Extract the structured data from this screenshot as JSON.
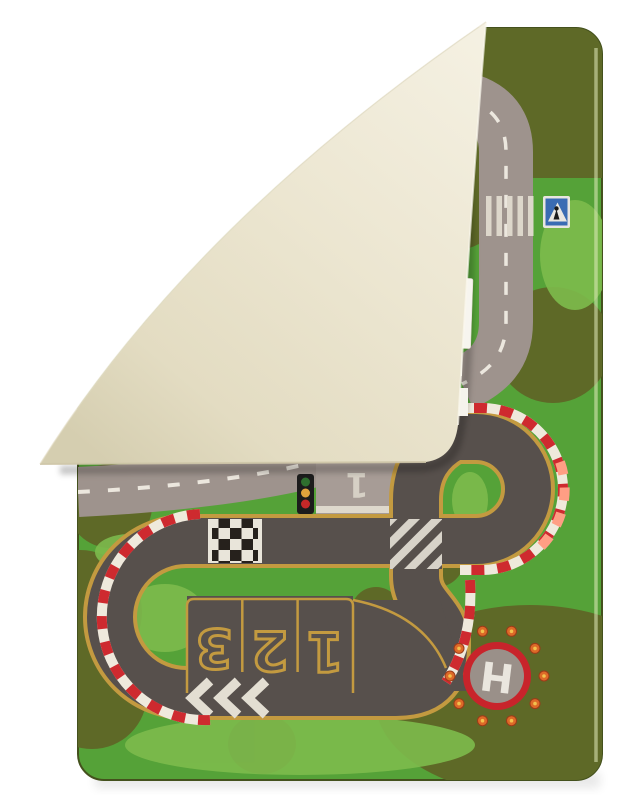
{
  "scene": {
    "type": "product-photo",
    "subject": "Children's play rug with roads and race track, top-left corner folded over showing cream backing",
    "background": "#ffffff"
  },
  "rug": {
    "front_colors": {
      "grass": "#55a238",
      "olive_patches": "#5e6927",
      "light_grass": "#7dbb4d",
      "racetrack": "#57504c",
      "road": "#9e938d",
      "track_edge_line": "#c39a40"
    },
    "backing_color": "#ebe5d0",
    "curb_colors": {
      "red": "#ce2a2f",
      "white": "#efe9dc",
      "salmon": "#ff9e84"
    }
  },
  "markings": {
    "parking_spots": [
      "3",
      "2",
      "1"
    ],
    "apron_number": "1",
    "helipad_letter": "H"
  },
  "icons": {
    "traffic-light": "three stacked lights green/amber/red",
    "pedestrian-crossing-sign": "blue square with white triangle and walking figure",
    "helipad": "red ring on grey pad with orange perimeter lights",
    "finish-line": "black and white checker band",
    "crosswalk": "white zebra bars",
    "chevrons": "three white left-pointing arrows",
    "diagonal-crossing": "white diagonal striped square"
  }
}
